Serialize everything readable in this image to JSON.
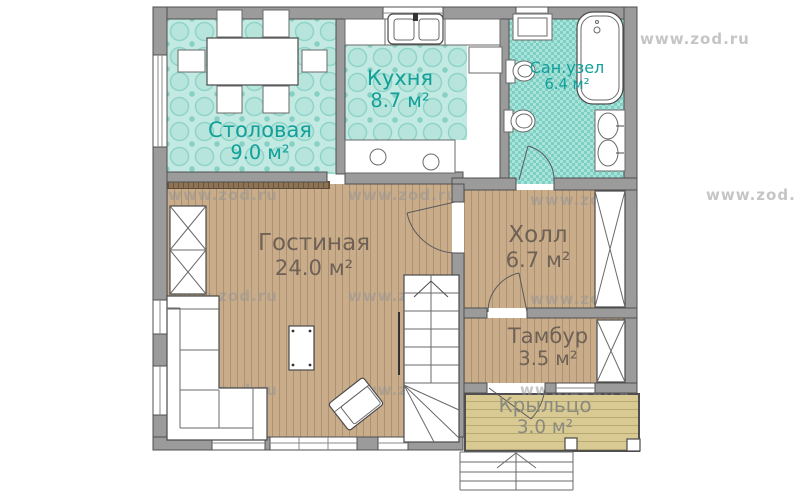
{
  "watermark": "www.zod.ru",
  "rooms": [
    {
      "name": "Столовая",
      "area": "9.0 м²"
    },
    {
      "name": "Кухня",
      "area": "8.7 м²"
    },
    {
      "name": "Сан.узел",
      "area": "6.4 м²"
    },
    {
      "name": "Гостиная",
      "area": "24.0 м²"
    },
    {
      "name": "Холл",
      "area": "6.7 м²"
    },
    {
      "name": "Тамбур",
      "area": "3.5 м²"
    },
    {
      "name": "Крыльцо",
      "area": "3.0 м²"
    }
  ],
  "colors": {
    "label-teal": "#12a09a",
    "label-brown": "#6f6156",
    "label-gray": "#8a8a7e",
    "wall": "#9b9b9b",
    "wall-edge": "#4f4f4f",
    "tile-floor": "#c3eae2",
    "checker-floor": "#a9e4db",
    "wood-floor": "#c9ad8b",
    "porch-floor": "#d9ca94"
  }
}
